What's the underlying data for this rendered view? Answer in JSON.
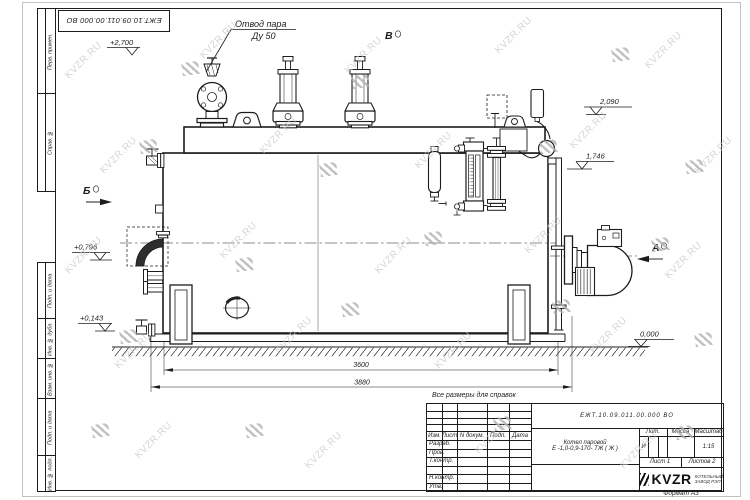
{
  "watermark": {
    "text": "KVZR.RU"
  },
  "margin_labels": [
    "Перв. примен.",
    "Справ. №",
    "Подп. и дата",
    "Инв. № дубл.",
    "Взам. инв. №",
    "Подп. и дата",
    "Инв. № подл."
  ],
  "annotations": {
    "steam_outlet_line1": "Отвод пара",
    "steam_outlet_line2": "Ду 50",
    "view_top": "В",
    "view_left": "Б",
    "view_right": "А",
    "reference_note": "Все размеры для справок"
  },
  "levels": [
    "+2,700",
    "2,090",
    "1,746",
    "+0,796",
    "+0,143",
    "0,000"
  ],
  "dimensions": [
    "3600",
    "3880"
  ],
  "title_block": {
    "doc_number": "ЕЖТ.10.09.011.00.000  ВО",
    "product_name_line1": "Котел паровой",
    "product_name_line2": "Е -1,0-0,9-170- ТЖ ( Ж )",
    "header_cells": [
      "Изм.",
      "Лист",
      "N докум.",
      "Подп.",
      "Дата"
    ],
    "row_labels": [
      "Разраб.",
      "Пров.",
      "Т.контр.",
      "Н.контр.",
      "Утв."
    ],
    "lit_label": "Лит.",
    "mass_label": "Масса",
    "scale_label": "Масштаб",
    "lit_value": "И",
    "scale_value": "1:15",
    "sheet_cell": "Лист 1",
    "sheets_cell": "Листов 2",
    "logo_text": "KVZR",
    "logo_sub_line1": "КОТЕЛЬНЫЙ",
    "logo_sub_line2": "ЗАВОД РЭП",
    "format_note": "Формат А3"
  }
}
